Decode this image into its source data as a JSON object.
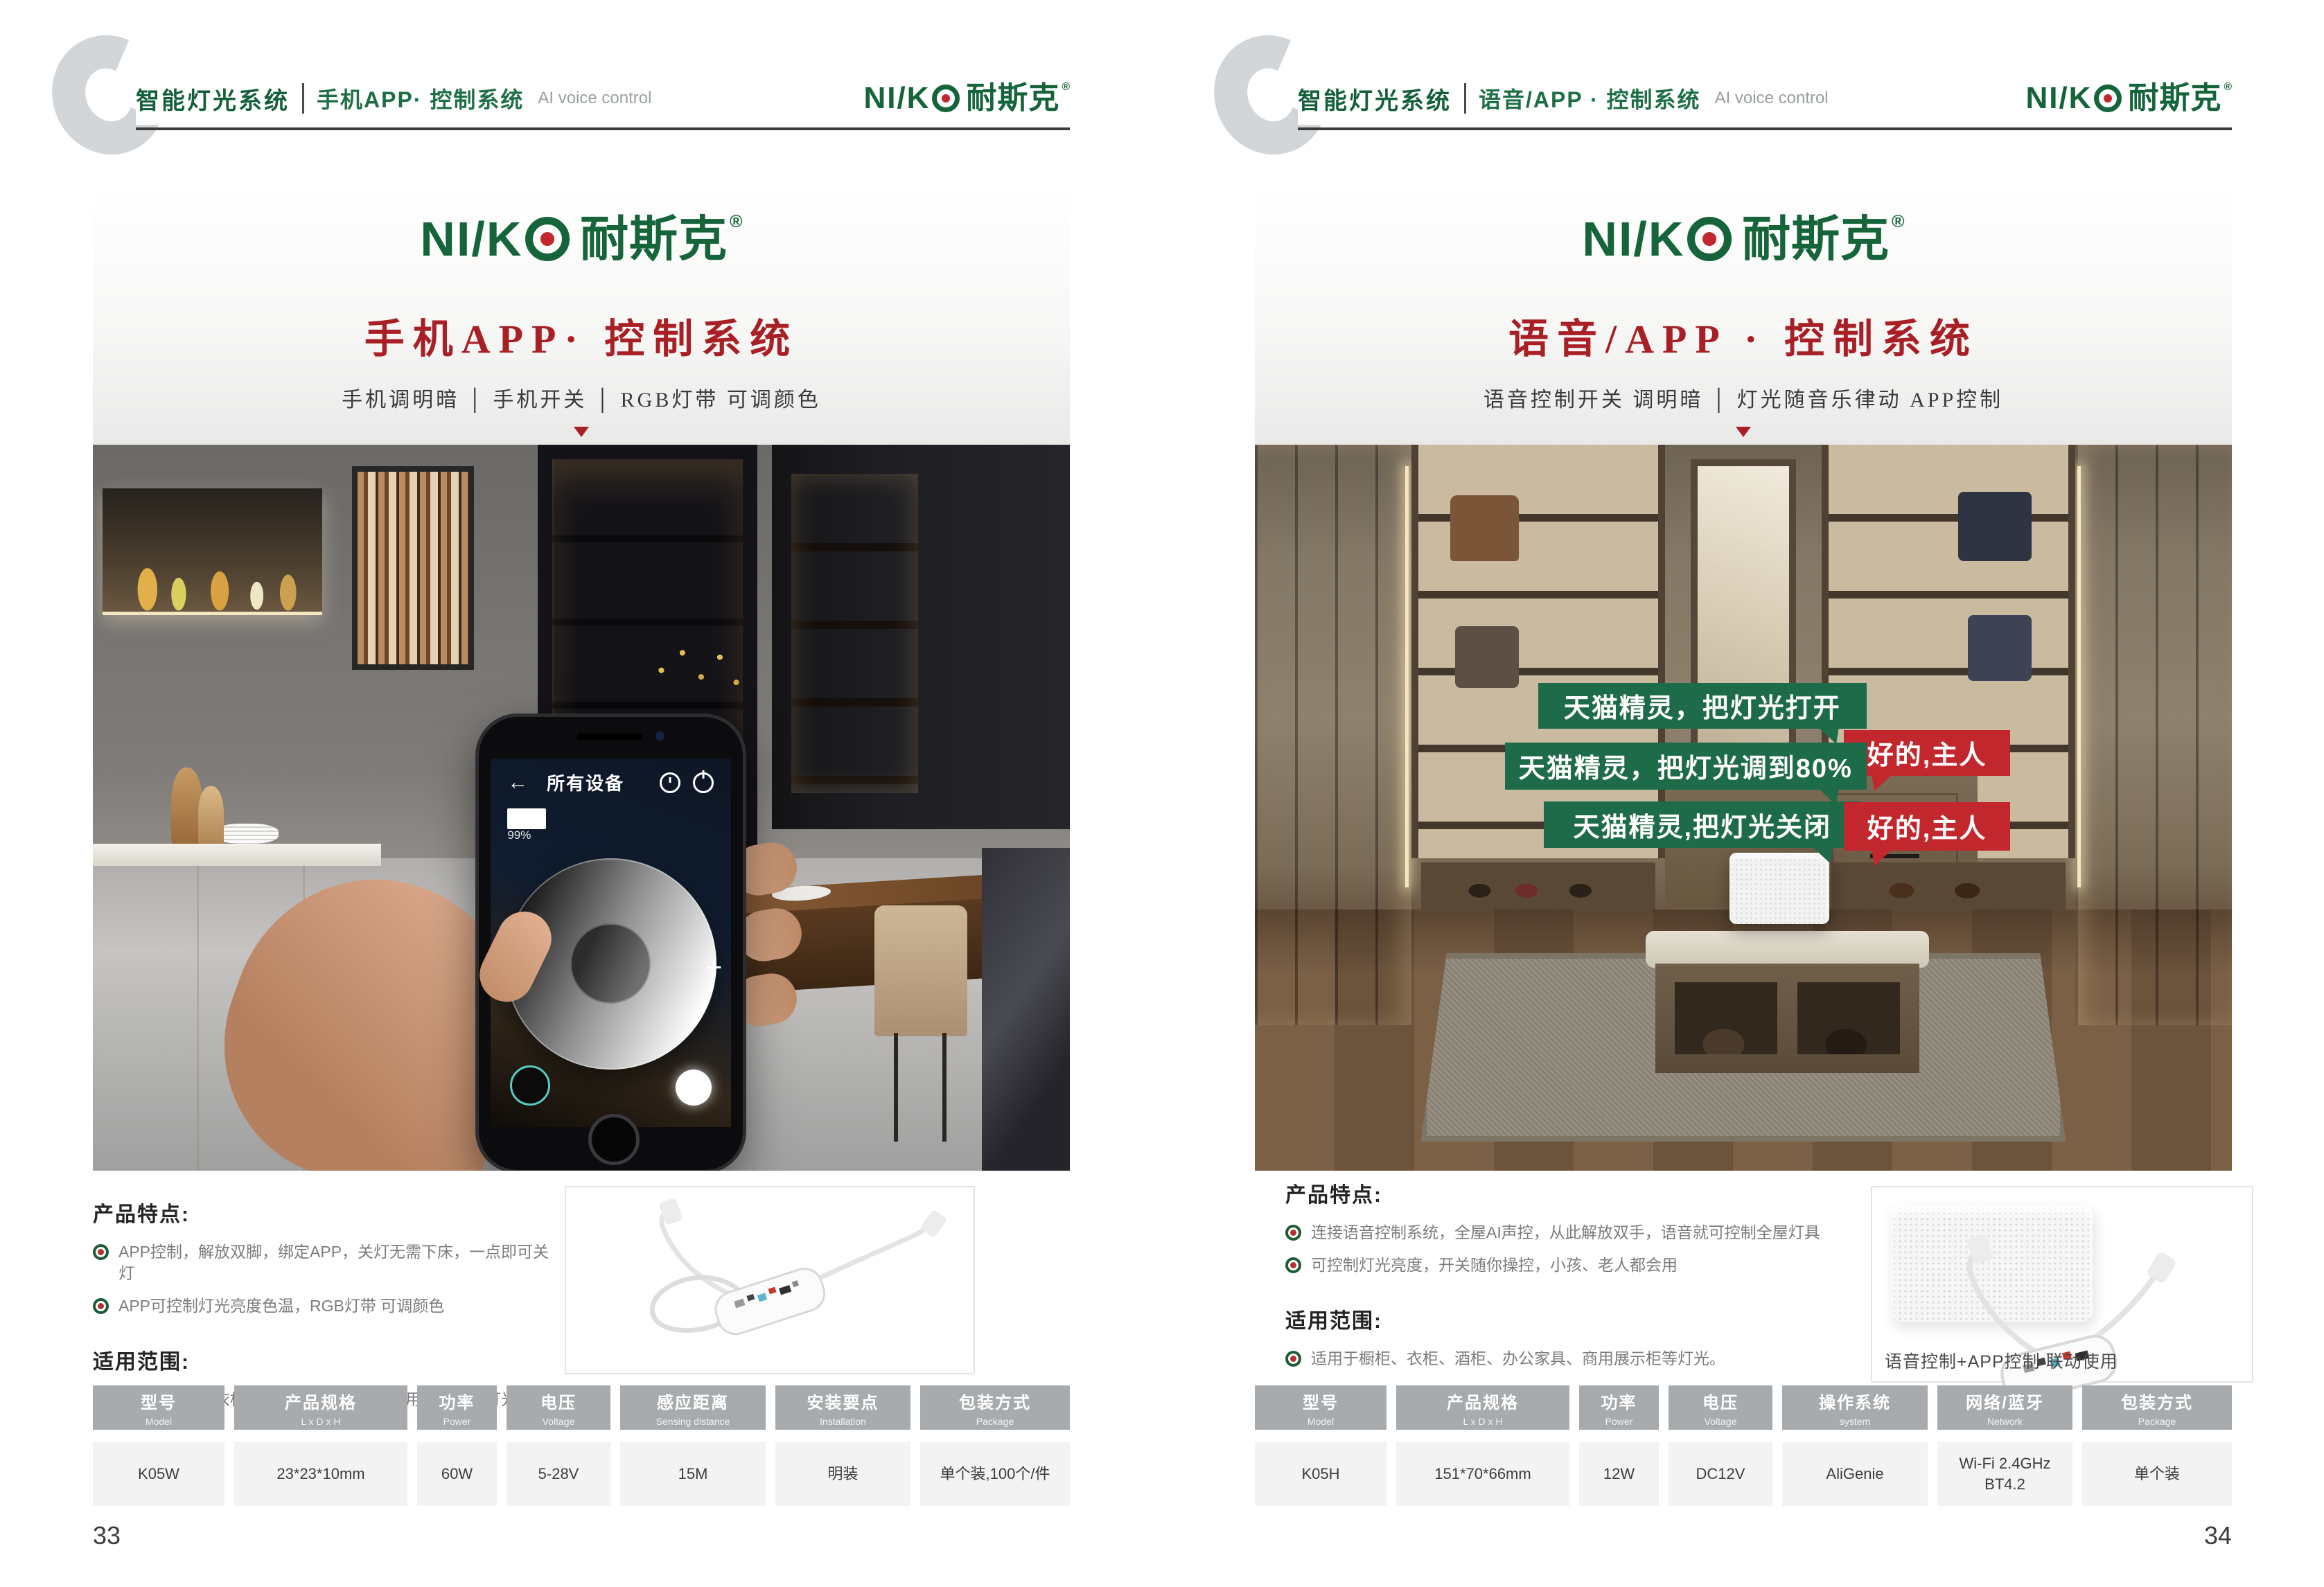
{
  "brand": {
    "latin": "NI/K",
    "cn": "耐斯克",
    "registered": "®",
    "green": "#15643a",
    "red_dot": "#c1272d"
  },
  "colors": {
    "title_red": "#a81f25",
    "bubble_green": "#1d6b48",
    "bubble_red": "#c2272d",
    "table_header_gray": "#a8abad",
    "table_cell_gray": "#f3f3f4"
  },
  "pages": {
    "left": {
      "header": {
        "section": "智能灯光系统",
        "title": "手机APP· 控制系统",
        "en": "AI voice control"
      },
      "banner": {
        "title": "手机APP· 控制系统",
        "subtitle": "手机调明暗 │ 手机开关 │ RGB灯带 可调颜色"
      },
      "phone_ui": {
        "back": "←",
        "nav_title": "所有设备",
        "battery_percent": "99%",
        "plus": "+"
      },
      "features": {
        "heading": "产品特点:",
        "items": [
          "APP控制，解放双脚，绑定APP，关灯无需下床，一点即可关灯",
          "APP可控制灯光亮度色温，RGB灯带 可调颜色"
        ]
      },
      "scope": {
        "heading": "适用范围:",
        "items": [
          "适用于橱柜、衣柜、酒柜、办公家具、商用展示柜等灯光。"
        ]
      },
      "table": {
        "columns": [
          {
            "label": "型号",
            "sub": "Model"
          },
          {
            "label": "产品规格",
            "sub": "L x D x H"
          },
          {
            "label": "功率",
            "sub": "Power"
          },
          {
            "label": "电压",
            "sub": "Voltage"
          },
          {
            "label": "感应距离",
            "sub": "Sensing distance"
          },
          {
            "label": "安装要点",
            "sub": "Installation"
          },
          {
            "label": "包装方式",
            "sub": "Package"
          }
        ],
        "row": [
          "K05W",
          "23*23*10mm",
          "60W",
          "5-28V",
          "15M",
          "明装",
          "单个装,100个/件"
        ]
      },
      "page_number": "33"
    },
    "right": {
      "header": {
        "section": "智能灯光系统",
        "title": "语音/APP · 控制系统",
        "en": "AI voice control"
      },
      "banner": {
        "title": "语音/APP · 控制系统",
        "subtitle": "语音控制开关  调明暗 │ 灯光随音乐律动  APP控制"
      },
      "bubbles": {
        "ask1": "天猫精灵，把灯光打开",
        "reply1": "好的,主人",
        "ask2": "天猫精灵，把灯光调到80%",
        "ask3": "天猫精灵,把灯光关闭",
        "reply2": "好的,主人"
      },
      "features": {
        "heading": "产品特点:",
        "items": [
          "连接语音控制系统，全屋AI声控，从此解放双手，语音就可控制全屋灯具",
          "可控制灯光亮度，开关随你操控，小孩、老人都会用"
        ]
      },
      "scope": {
        "heading": "适用范围:",
        "items": [
          "适用于橱柜、衣柜、酒柜、办公家具、商用展示柜等灯光。"
        ]
      },
      "thumb_caption": "语音控制+APP控制 联动使用",
      "table": {
        "columns": [
          {
            "label": "型号",
            "sub": "Model"
          },
          {
            "label": "产品规格",
            "sub": "L x D x H"
          },
          {
            "label": "功率",
            "sub": "Power"
          },
          {
            "label": "电压",
            "sub": "Voltage"
          },
          {
            "label": "操作系统",
            "sub": "system"
          },
          {
            "label": "网络/蓝牙",
            "sub": "Network"
          },
          {
            "label": "包装方式",
            "sub": "Package"
          }
        ],
        "row": [
          "K05H",
          "151*70*66mm",
          "12W",
          "DC12V",
          "AliGenie",
          "Wi-Fi 2.4GHz BT4.2",
          "单个装"
        ]
      },
      "page_number": "34"
    }
  }
}
